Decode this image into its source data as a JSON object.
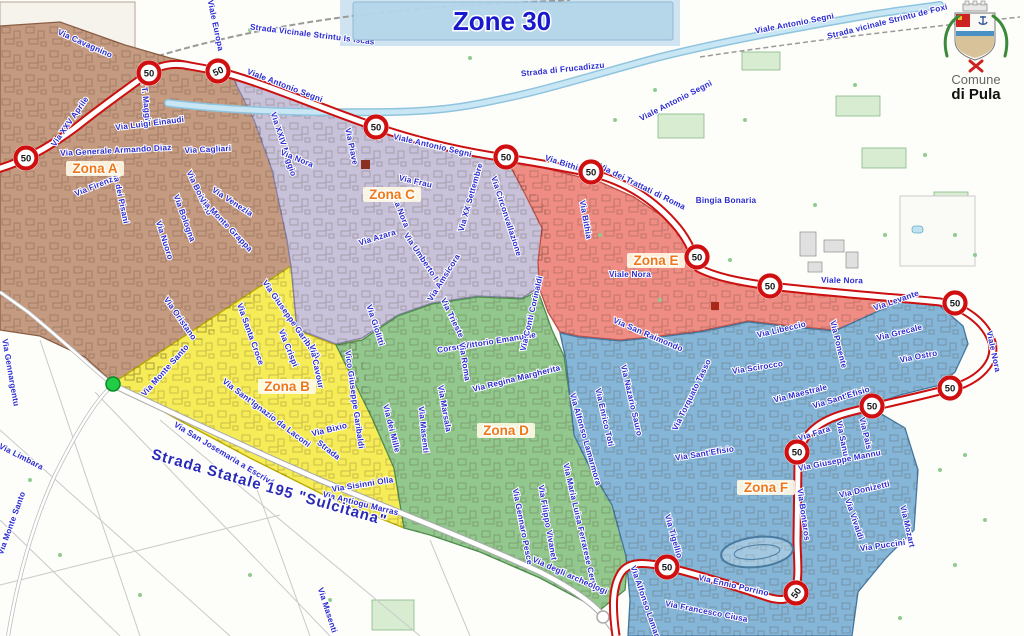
{
  "title": "Zone 30",
  "banner": {
    "bg": "#b5d6ea",
    "title_color": "#1818cc"
  },
  "municipality": {
    "line1": "Comune",
    "line2": "di Pula"
  },
  "speed_sign": {
    "value": "50",
    "ring": "#d01010"
  },
  "route": {
    "casing": "#cc1010",
    "fill": "#ffffff"
  },
  "river": {
    "color": "#8fc4de"
  },
  "label_style": {
    "street_color": "#2b2bd0",
    "zone_color": "#f07818",
    "zone_bg": "#fffbe6"
  },
  "highway": {
    "name": "Strada Statale 195 \"Sulcitana\"",
    "x": 268,
    "y": 492,
    "rot": 16,
    "size": 15
  },
  "zones": [
    {
      "id": "A",
      "label": "Zona A",
      "color": "#c49a81",
      "border": "#8a5e44",
      "lx": 95,
      "ly": 172
    },
    {
      "id": "B",
      "label": "Zona B",
      "color": "#f5ec57",
      "border": "#b9a900",
      "lx": 287,
      "ly": 390
    },
    {
      "id": "C",
      "label": "Zona C",
      "color": "#c7c2d9",
      "border": "#8880a8",
      "lx": 392,
      "ly": 198
    },
    {
      "id": "D",
      "label": "Zona D",
      "color": "#92c78e",
      "border": "#4e8f4e",
      "lx": 506,
      "ly": 434
    },
    {
      "id": "E",
      "label": "Zona E",
      "color": "#ef8d84",
      "border": "#c05048",
      "lx": 656,
      "ly": 264
    },
    {
      "id": "F",
      "label": "Zona F",
      "color": "#85b6d8",
      "border": "#44779f",
      "lx": 766,
      "ly": 491
    }
  ],
  "signs": [
    {
      "x": 26,
      "y": 158,
      "r": 0
    },
    {
      "x": 149,
      "y": 73,
      "r": 0
    },
    {
      "x": 218,
      "y": 71,
      "r": -25
    },
    {
      "x": 376,
      "y": 127,
      "r": 0
    },
    {
      "x": 506,
      "y": 157,
      "r": 0
    },
    {
      "x": 591,
      "y": 172,
      "r": 0
    },
    {
      "x": 697,
      "y": 257,
      "r": 0
    },
    {
      "x": 770,
      "y": 286,
      "r": 0
    },
    {
      "x": 955,
      "y": 303,
      "r": 0
    },
    {
      "x": 950,
      "y": 388,
      "r": 0
    },
    {
      "x": 872,
      "y": 406,
      "r": 0
    },
    {
      "x": 797,
      "y": 452,
      "r": 0
    },
    {
      "x": 667,
      "y": 567,
      "r": 0
    },
    {
      "x": 796,
      "y": 593,
      "r": -55
    }
  ],
  "streets": [
    {
      "n": "Via Cavagnino",
      "x": 84,
      "y": 46,
      "r": 24
    },
    {
      "n": "Viale Europa",
      "x": 213,
      "y": 26,
      "r": 78
    },
    {
      "n": "Via XXV Aprile",
      "x": 72,
      "y": 123,
      "r": -55
    },
    {
      "n": "Via T. Maggio",
      "x": 143,
      "y": 99,
      "r": 84
    },
    {
      "n": "Via Luigi Einaudi",
      "x": 150,
      "y": 126,
      "r": -7
    },
    {
      "n": "Via Generale Armando Diaz",
      "x": 116,
      "y": 153,
      "r": -3
    },
    {
      "n": "Via Cagliari",
      "x": 208,
      "y": 152,
      "r": -3
    },
    {
      "n": "Via Firenze",
      "x": 97,
      "y": 188,
      "r": -22
    },
    {
      "n": "Via dei Pisani",
      "x": 118,
      "y": 197,
      "r": 78
    },
    {
      "n": "Via Bolzano",
      "x": 197,
      "y": 194,
      "r": 64
    },
    {
      "n": "Via Venezia",
      "x": 231,
      "y": 204,
      "r": 33
    },
    {
      "n": "Via Bologna",
      "x": 182,
      "y": 219,
      "r": 70
    },
    {
      "n": "Via Monte Grappa",
      "x": 224,
      "y": 226,
      "r": 46
    },
    {
      "n": "Via Nuoro",
      "x": 162,
      "y": 241,
      "r": 72
    },
    {
      "n": "Via Oristano",
      "x": 178,
      "y": 320,
      "r": 55
    },
    {
      "n": "Via Monte Santo",
      "x": 167,
      "y": 372,
      "r": -48
    },
    {
      "n": "Via Monte Santo",
      "x": 14,
      "y": 524,
      "r": -70
    },
    {
      "n": "Via Gennargentu",
      "x": 8,
      "y": 373,
      "r": 80
    },
    {
      "n": "Via Limbara",
      "x": 20,
      "y": 459,
      "r": 27
    },
    {
      "n": "Via Santa Croce",
      "x": 248,
      "y": 335,
      "r": 70
    },
    {
      "n": "Via Giuseppe Garibaldi",
      "x": 289,
      "y": 321,
      "r": 55
    },
    {
      "n": "Via Crispi",
      "x": 286,
      "y": 349,
      "r": 68
    },
    {
      "n": "Via Cavour",
      "x": 314,
      "y": 367,
      "r": 78
    },
    {
      "n": "Via Giolitti",
      "x": 373,
      "y": 326,
      "r": 72
    },
    {
      "n": "Vico Giuseppe Garibaldi",
      "x": 352,
      "y": 400,
      "r": 82
    },
    {
      "n": "Via Sant'Ignazio da Laconi",
      "x": 265,
      "y": 415,
      "r": 37
    },
    {
      "n": "Via San Josemaria a Escrivá",
      "x": 223,
      "y": 456,
      "r": 31
    },
    {
      "n": "Via Bixio",
      "x": 330,
      "y": 432,
      "r": -14
    },
    {
      "n": "Strada",
      "x": 327,
      "y": 452,
      "r": 38
    },
    {
      "n": "Via dei Mille",
      "x": 389,
      "y": 429,
      "r": 76
    },
    {
      "n": "Via Masenti",
      "x": 421,
      "y": 430,
      "r": 84
    },
    {
      "n": "Via Sisinni Olla",
      "x": 363,
      "y": 487,
      "r": -9
    },
    {
      "n": "Via Antiogu Marras",
      "x": 360,
      "y": 506,
      "r": 14
    },
    {
      "n": "Via Masenti",
      "x": 325,
      "y": 611,
      "r": 72
    },
    {
      "n": "Strada Vicinale Strintu Is Iscas",
      "x": 312,
      "y": 37,
      "r": 7
    },
    {
      "n": "Viale Antonio Segni",
      "x": 284,
      "y": 88,
      "r": 21
    },
    {
      "n": "Viale Antonio Segni",
      "x": 432,
      "y": 148,
      "r": 13
    },
    {
      "n": "Viale Antonio Segni",
      "x": 677,
      "y": 103,
      "r": -27
    },
    {
      "n": "Viale Antonio Segni",
      "x": 795,
      "y": 26,
      "r": -11
    },
    {
      "n": "Strada di Frucadizzu",
      "x": 563,
      "y": 72,
      "r": -6
    },
    {
      "n": "Strada vicinale Strintu de Foxi",
      "x": 888,
      "y": 24,
      "r": -14
    },
    {
      "n": "Via XXIV Maggio",
      "x": 281,
      "y": 145,
      "r": 72
    },
    {
      "n": "Via Nora",
      "x": 296,
      "y": 161,
      "r": 22
    },
    {
      "n": "Via Nora",
      "x": 398,
      "y": 212,
      "r": 68
    },
    {
      "n": "Via Piave",
      "x": 349,
      "y": 147,
      "r": 78
    },
    {
      "n": "Via Frau",
      "x": 415,
      "y": 184,
      "r": 13
    },
    {
      "n": "Via Azara",
      "x": 378,
      "y": 240,
      "r": -17
    },
    {
      "n": "Via Umberto I",
      "x": 419,
      "y": 258,
      "r": 56
    },
    {
      "n": "Via XX Settembre",
      "x": 473,
      "y": 198,
      "r": -74
    },
    {
      "n": "Via Circonvallazione",
      "x": 504,
      "y": 217,
      "r": 72
    },
    {
      "n": "Via Amsicora",
      "x": 446,
      "y": 279,
      "r": -58
    },
    {
      "n": "Via Trieste",
      "x": 450,
      "y": 319,
      "r": 64
    },
    {
      "n": "Corso Vittorio Emanuele",
      "x": 487,
      "y": 345,
      "r": -9
    },
    {
      "n": "Via Roma",
      "x": 462,
      "y": 362,
      "r": 81
    },
    {
      "n": "Via Regina Margherita",
      "x": 517,
      "y": 381,
      "r": -14
    },
    {
      "n": "Via Conti Corinaldi",
      "x": 534,
      "y": 314,
      "r": -77
    },
    {
      "n": "Via Marsala",
      "x": 442,
      "y": 409,
      "r": 80
    },
    {
      "n": "Via Gennaro Pesce",
      "x": 520,
      "y": 527,
      "r": 79
    },
    {
      "n": "Via Filippo Vivanet",
      "x": 545,
      "y": 523,
      "r": 80
    },
    {
      "n": "Via Maria Luisa Ferrarese Ceruti",
      "x": 578,
      "y": 528,
      "r": 77
    },
    {
      "n": "Via degli archeologi",
      "x": 569,
      "y": 578,
      "r": 24
    },
    {
      "n": "Via Bithia",
      "x": 563,
      "y": 166,
      "r": 18
    },
    {
      "n": "Via Bithia",
      "x": 583,
      "y": 220,
      "r": 80
    },
    {
      "n": "Via dei Trattati di Roma",
      "x": 641,
      "y": 189,
      "r": 26
    },
    {
      "n": "Bingia Bonaria",
      "x": 726,
      "y": 203,
      "r": 0
    },
    {
      "n": "Viale Nora",
      "x": 630,
      "y": 277,
      "r": 0
    },
    {
      "n": "Viale Nora",
      "x": 842,
      "y": 283,
      "r": 1
    },
    {
      "n": "Viale Nora",
      "x": 991,
      "y": 352,
      "r": 78
    },
    {
      "n": "Via San Raimondo",
      "x": 647,
      "y": 337,
      "r": 23
    },
    {
      "n": "Via Libeccio",
      "x": 782,
      "y": 332,
      "r": -13
    },
    {
      "n": "Via Ponente",
      "x": 836,
      "y": 345,
      "r": 76
    },
    {
      "n": "Via Levante",
      "x": 897,
      "y": 303,
      "r": -19
    },
    {
      "n": "Via Scirocco",
      "x": 758,
      "y": 370,
      "r": -9
    },
    {
      "n": "Via Grecale",
      "x": 900,
      "y": 335,
      "r": -14
    },
    {
      "n": "Via Maestrale",
      "x": 801,
      "y": 396,
      "r": -14
    },
    {
      "n": "Via Ostro",
      "x": 919,
      "y": 359,
      "r": -11
    },
    {
      "n": "Via Torquato Tasso",
      "x": 694,
      "y": 396,
      "r": -64
    },
    {
      "n": "Via Nazario Sauro",
      "x": 629,
      "y": 401,
      "r": 77
    },
    {
      "n": "Via Enrico Toti",
      "x": 602,
      "y": 418,
      "r": 77
    },
    {
      "n": "Via Alfonso Lamarmora",
      "x": 583,
      "y": 440,
      "r": 74
    },
    {
      "n": "Via Sant'Efisio",
      "x": 705,
      "y": 456,
      "r": -9
    },
    {
      "n": "Via Sant'Efisio",
      "x": 842,
      "y": 400,
      "r": -17
    },
    {
      "n": "Via Fara",
      "x": 815,
      "y": 436,
      "r": -18
    },
    {
      "n": "Via Sanu",
      "x": 840,
      "y": 439,
      "r": 79
    },
    {
      "n": "Via Pais",
      "x": 863,
      "y": 434,
      "r": 77
    },
    {
      "n": "Via Giuseppe Mannu",
      "x": 840,
      "y": 463,
      "r": -11
    },
    {
      "n": "Via Donizetti",
      "x": 865,
      "y": 492,
      "r": -13
    },
    {
      "n": "Via Vivaldi",
      "x": 852,
      "y": 520,
      "r": 71
    },
    {
      "n": "Via Puccini",
      "x": 883,
      "y": 548,
      "r": -8
    },
    {
      "n": "Via Mozart",
      "x": 905,
      "y": 527,
      "r": 77
    },
    {
      "n": "Via Bontaros",
      "x": 801,
      "y": 515,
      "r": 82
    },
    {
      "n": "Via Ennio Porrino",
      "x": 733,
      "y": 588,
      "r": 13
    },
    {
      "n": "Via Francesco Ciusa",
      "x": 706,
      "y": 614,
      "r": 11
    },
    {
      "n": "Via Tigellio",
      "x": 671,
      "y": 537,
      "r": 74
    },
    {
      "n": "Via Alfonso Lamarmora",
      "x": 646,
      "y": 612,
      "r": 71
    }
  ]
}
